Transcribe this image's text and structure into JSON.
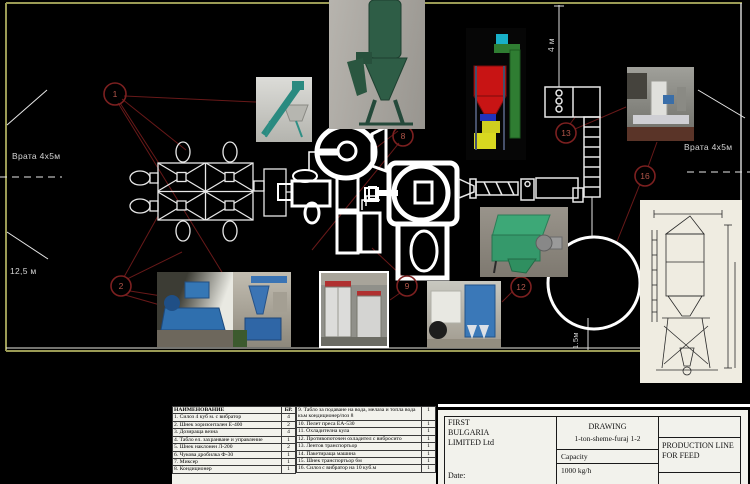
{
  "plan_labels": {
    "gate_left": "Врата 4х5м",
    "gate_right": "Врата 4х5м",
    "hall_width": "12,5 м",
    "dim_4m": "4 м",
    "dim_1_5m": "1.5м"
  },
  "callouts": [
    {
      "num": "1"
    },
    {
      "num": "2"
    },
    {
      "num": "8"
    },
    {
      "num": "9"
    },
    {
      "num": "12"
    },
    {
      "num": "13"
    },
    {
      "num": "16"
    }
  ],
  "colors": {
    "background": "#000000",
    "wall": "#9b9b55",
    "symbol_lines": "#ffffff",
    "callout_red": "#7c2020",
    "paper": "#f2f2ec"
  },
  "equipment_table": {
    "header_name": "НАИМЕНОВАНИЕ",
    "header_qty": "БР.",
    "rows_left": [
      {
        "name": "1. Силоз 4 куб м. с вибратор",
        "qty": "4"
      },
      {
        "name": "2. Шнек хоризонтален Е-400",
        "qty": "2"
      },
      {
        "name": "3. Дозираща везна",
        "qty": "4"
      },
      {
        "name": "4. Табло ел. захранване и управление",
        "qty": "1"
      },
      {
        "name": "5. Шнек наклонен Л-200",
        "qty": "2"
      },
      {
        "name": "6. Чукова дробилка Ф-30",
        "qty": "1"
      },
      {
        "name": "7. Миксер",
        "qty": "1"
      },
      {
        "name": "8. Кондиционер",
        "qty": "1"
      }
    ],
    "rows_right": [
      {
        "name": "9. Табло за подаване на вода, мелаза и топла вода към кондиционер/поз 8",
        "qty": "1"
      },
      {
        "name": "10. Пелет преса ЕА-530",
        "qty": "1"
      },
      {
        "name": "11. Охладителна кула",
        "qty": "1"
      },
      {
        "name": "12. Противопоточен охладител с вибросито",
        "qty": "1"
      },
      {
        "name": "13. Лентов транспортьор",
        "qty": "1"
      },
      {
        "name": "14. Пакетираща машина",
        "qty": "1"
      },
      {
        "name": "15. Шнек транспортьор 6м",
        "qty": "1"
      },
      {
        "name": "16. Силоз с вибратор на 10 куб.м",
        "qty": "1"
      }
    ]
  },
  "title_block": {
    "company_line1": "FIRST",
    "company_line2": "BULGARIA",
    "company_line3": "LIMITED Ltd",
    "date_label": "Date:",
    "drawing_label": "DRAWING",
    "drawing_name": "1-ton-sheme-furaj 1-2",
    "capacity_label": "Capacity",
    "capacity_value": "1000 kg/h",
    "product_line": "PRODUCTION LINE FOR FEED"
  }
}
